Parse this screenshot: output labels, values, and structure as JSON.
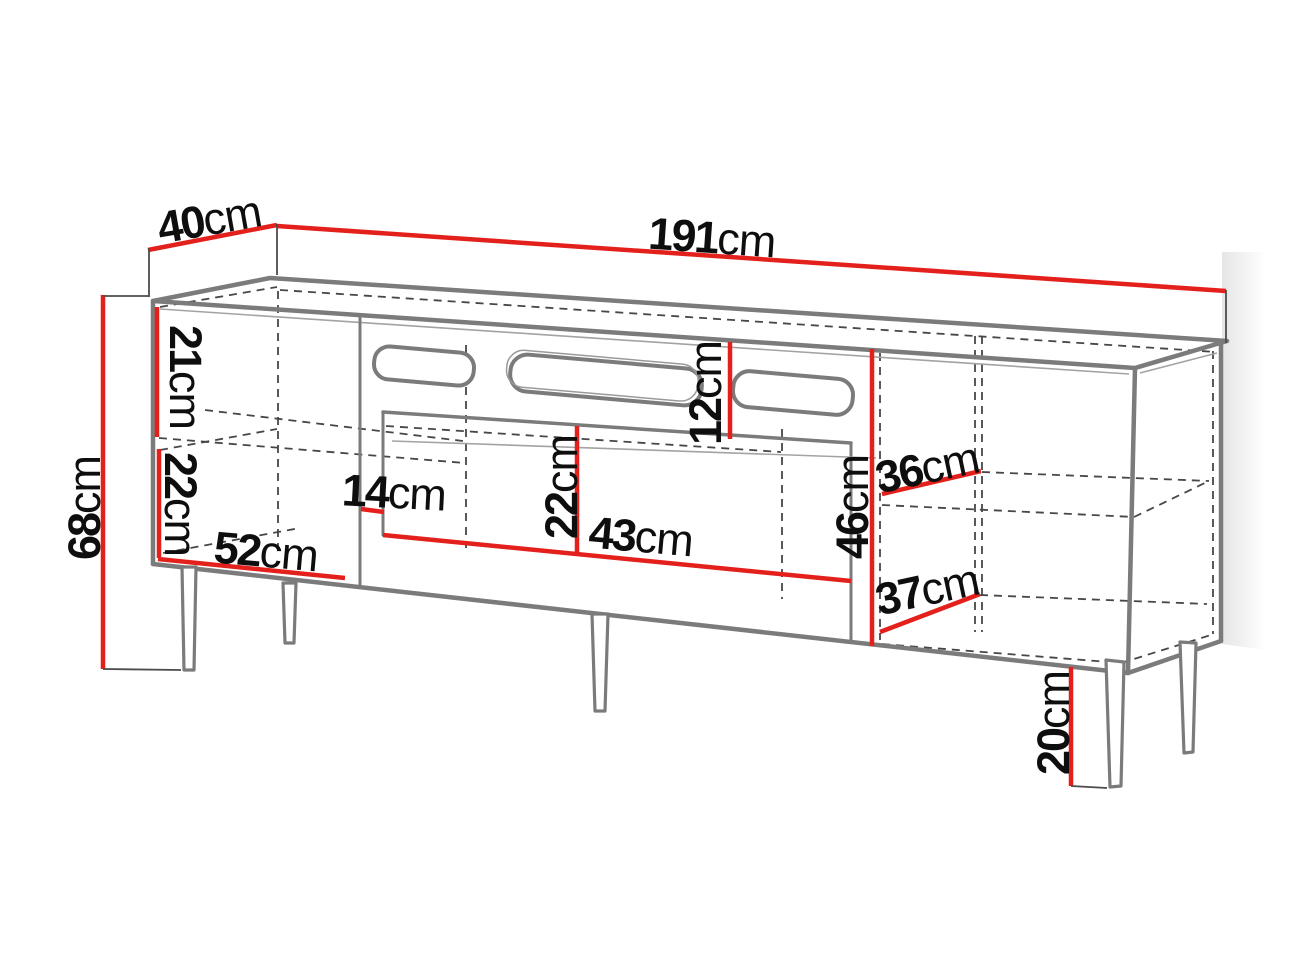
{
  "diagram": {
    "title": "TV cabinet dimension diagram",
    "unit": "cm",
    "colors": {
      "dimension_line": "#e4201c",
      "outline": "#7b7b7b",
      "text": "#0e0e0e",
      "background": "#ffffff"
    },
    "labels": [
      {
        "id": "depth-top",
        "value": "40",
        "unit": "cm"
      },
      {
        "id": "width-total",
        "value": "191",
        "unit": "cm"
      },
      {
        "id": "height-total",
        "value": "68",
        "unit": "cm"
      },
      {
        "id": "left-upper-height",
        "value": "21",
        "unit": "cm"
      },
      {
        "id": "left-lower-height",
        "value": "22",
        "unit": "cm"
      },
      {
        "id": "left-width",
        "value": "52",
        "unit": "cm"
      },
      {
        "id": "center-gap-width",
        "value": "14",
        "unit": "cm"
      },
      {
        "id": "center-opening-height",
        "value": "22",
        "unit": "cm"
      },
      {
        "id": "center-opening-width",
        "value": "43",
        "unit": "cm"
      },
      {
        "id": "top-opening-height",
        "value": "12",
        "unit": "cm"
      },
      {
        "id": "right-opening-height",
        "value": "46",
        "unit": "cm"
      },
      {
        "id": "right-shelf-upper-depth",
        "value": "36",
        "unit": "cm"
      },
      {
        "id": "right-shelf-lower-depth",
        "value": "37",
        "unit": "cm"
      },
      {
        "id": "leg-height",
        "value": "20",
        "unit": "cm"
      }
    ]
  }
}
